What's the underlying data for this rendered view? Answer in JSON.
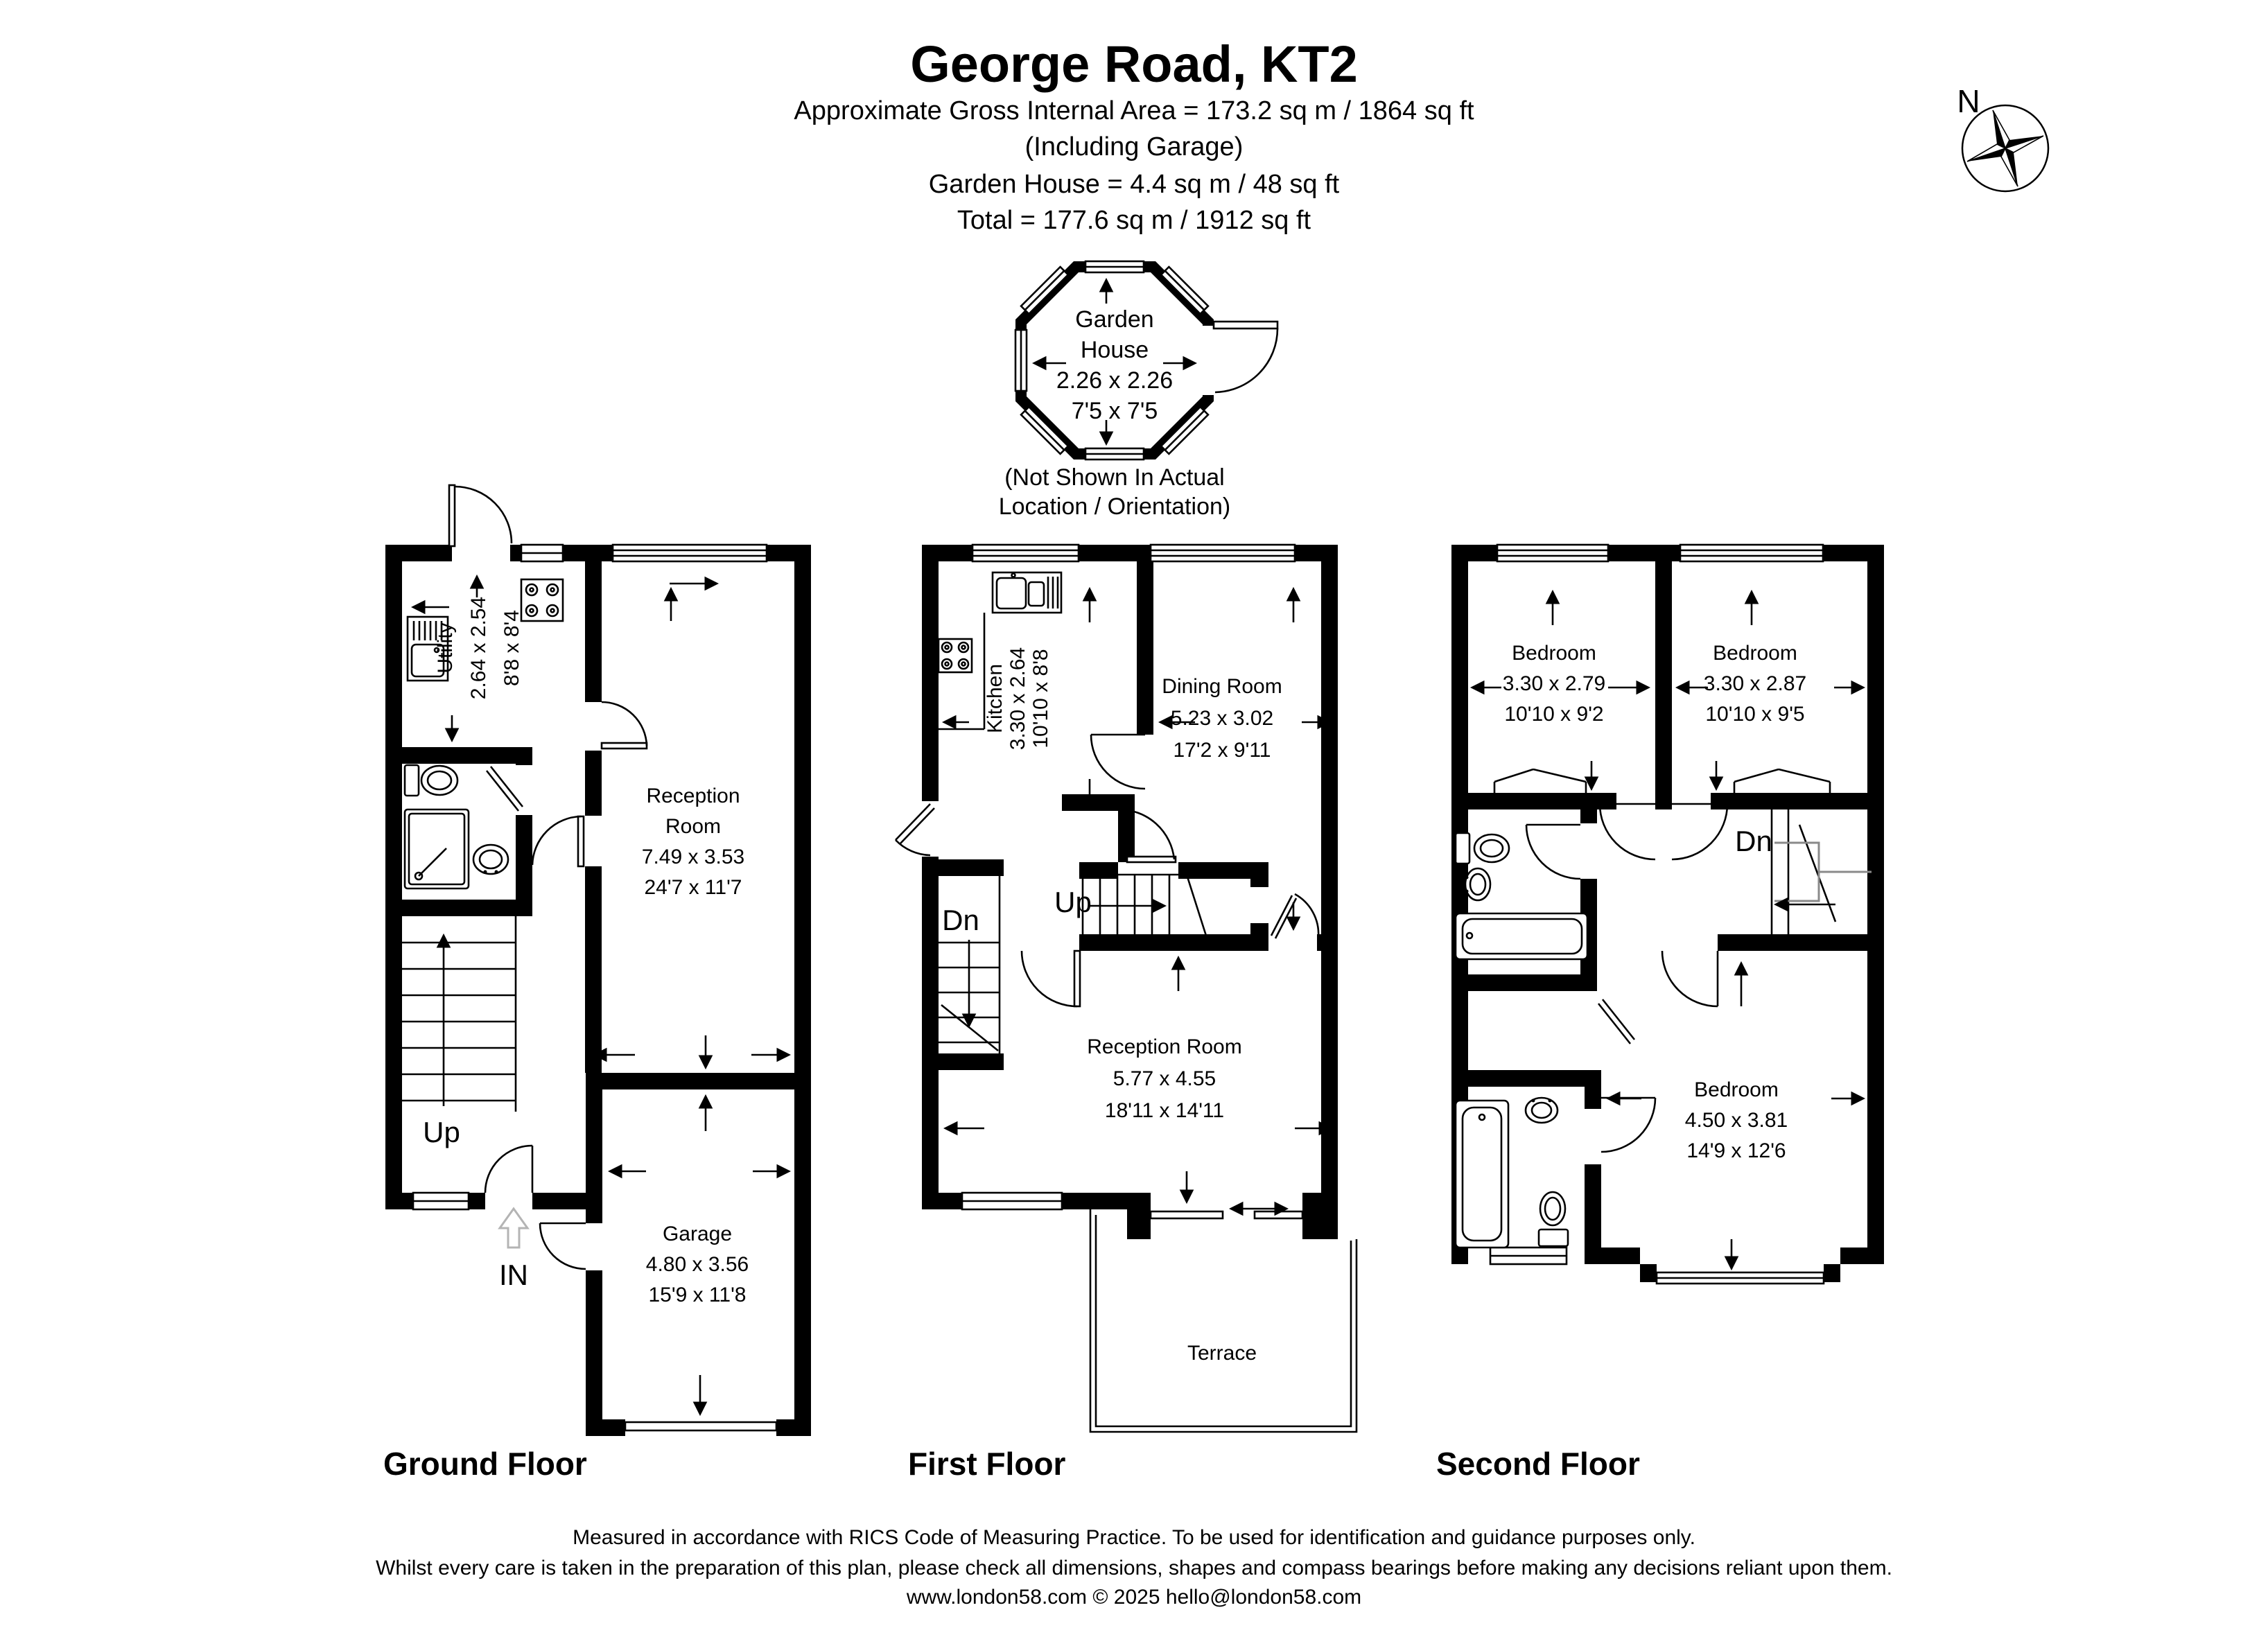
{
  "title": {
    "heading": "George Road, KT2",
    "line1": "Approximate Gross Internal Area = 173.2 sq m / 1864 sq ft",
    "line2": "(Including Garage)",
    "line3": "Garden House  = 4.4 sq m / 48 sq ft",
    "line4": "Total = 177.6 sq m / 1912 sq ft"
  },
  "compass": {
    "north_label": "N"
  },
  "garden_house": {
    "name_line1": "Garden",
    "name_line2": "House",
    "size_metric": "2.26 x 2.26",
    "size_imperial": "7'5 x 7'5",
    "note_line1": "(Not Shown In Actual",
    "note_line2": "Location / Orientation)"
  },
  "floors": {
    "ground": {
      "label": "Ground Floor",
      "utility": {
        "name": "Utility",
        "metric": "2.64 x 2.54",
        "imperial": "8'8 x 8'4"
      },
      "reception": {
        "name_line1": "Reception",
        "name_line2": "Room",
        "metric": "7.49 x 3.53",
        "imperial": "24'7 x 11'7"
      },
      "garage": {
        "name": "Garage",
        "metric": "4.80 x 3.56",
        "imperial": "15'9 x 11'8"
      },
      "stairs_label": "Up",
      "entrance_label": "IN"
    },
    "first": {
      "label": "First Floor",
      "kitchen": {
        "name": "Kitchen",
        "metric": "3.30 x 2.64",
        "imperial": "10'10 x 8'8"
      },
      "dining": {
        "name": "Dining Room",
        "metric": "5.23 x 3.02",
        "imperial": "17'2 x 9'11"
      },
      "reception": {
        "name": "Reception Room",
        "metric": "5.77 x 4.55",
        "imperial": "18'11 x 14'11"
      },
      "terrace": {
        "name": "Terrace"
      },
      "stairs_up_label": "Up",
      "stairs_down_label": "Dn"
    },
    "second": {
      "label": "Second Floor",
      "bedroom1": {
        "name": "Bedroom",
        "metric": "3.30 x 2.79",
        "imperial": "10'10 x 9'2"
      },
      "bedroom2": {
        "name": "Bedroom",
        "metric": "3.30 x 2.87",
        "imperial": "10'10 x 9'5"
      },
      "bedroom3": {
        "name": "Bedroom",
        "metric": "4.50 x 3.81",
        "imperial": "14'9 x 12'6"
      },
      "stairs_down_label": "Dn"
    }
  },
  "footer": {
    "line1": "Measured in accordance with RICS Code of Measuring Practice. To be used for identification and guidance purposes only.",
    "line2": "Whilst every care is taken in the preparation of this plan, please check all dimensions, shapes and compass bearings before making any decisions reliant upon them.",
    "line3": "www.london58.com © 2025 hello@london58.com"
  },
  "colors": {
    "ink": "#000000",
    "background": "#ffffff",
    "stair_rail_gray": "#8a8a8a",
    "entry_arrow_gray": "#b4b4b4"
  }
}
